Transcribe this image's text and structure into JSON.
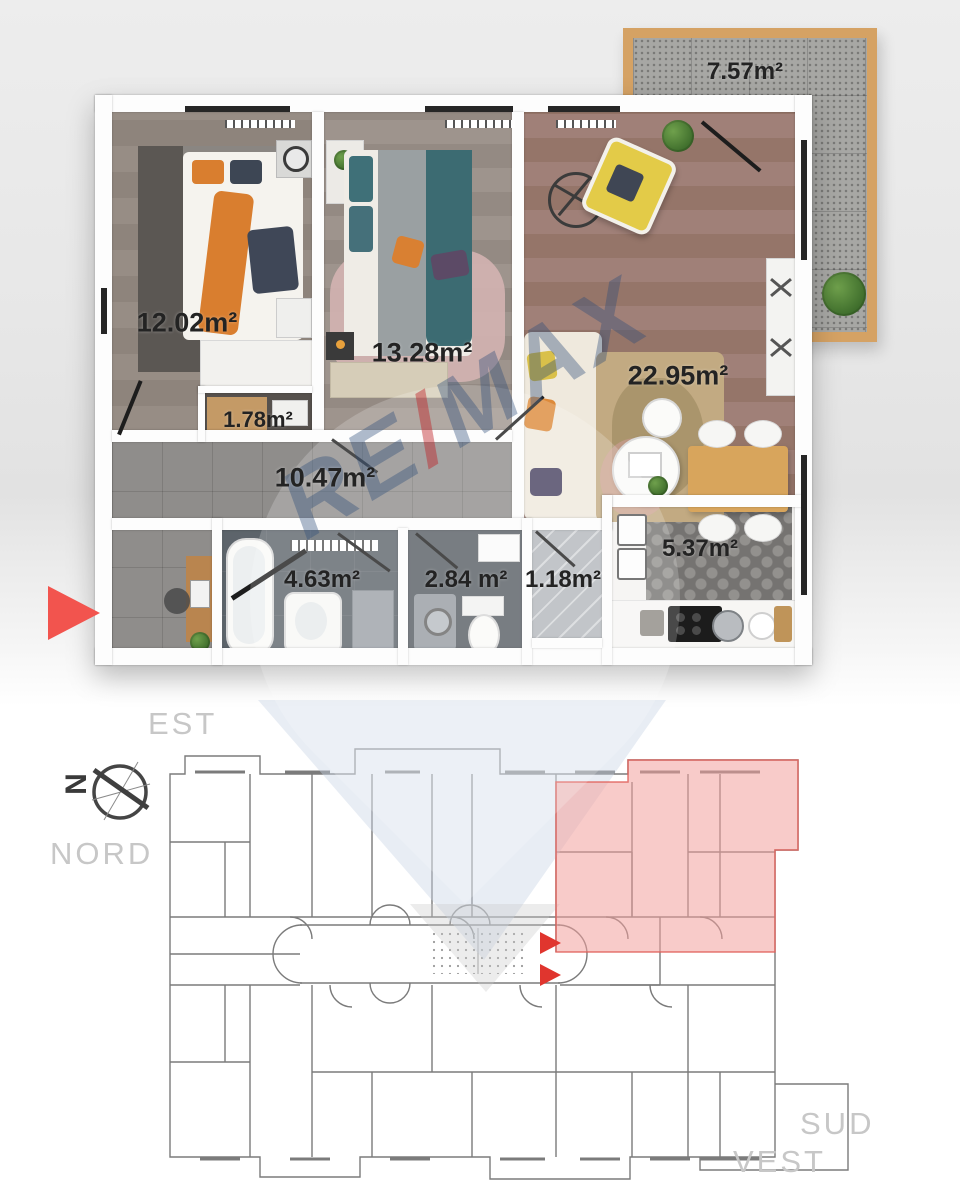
{
  "floor_plan": {
    "rooms": {
      "bedroom1": "12.02m²",
      "closet": "1.78m²",
      "bedroom2": "13.28m²",
      "living": "22.95m²",
      "hallway": "10.47m²",
      "bathroom": "4.63m²",
      "toilet": "2.84 m²",
      "storage": "1.18m²",
      "kitchen": "5.37m²",
      "terrace": "7.57m²"
    }
  },
  "watermark": {
    "re": "RE",
    "slash": "/",
    "max": "MAX"
  },
  "site_plan": {
    "compass_letter": "N",
    "directions": {
      "est": "EST",
      "nord": "NORD",
      "sud": "SUD",
      "vest": "VEST"
    }
  },
  "colors": {
    "accent_red": "#e8423c",
    "highlight_pink": "#f2a09c",
    "terrace_wood": "#d5a264",
    "label_gray": "#c7c7c7"
  }
}
